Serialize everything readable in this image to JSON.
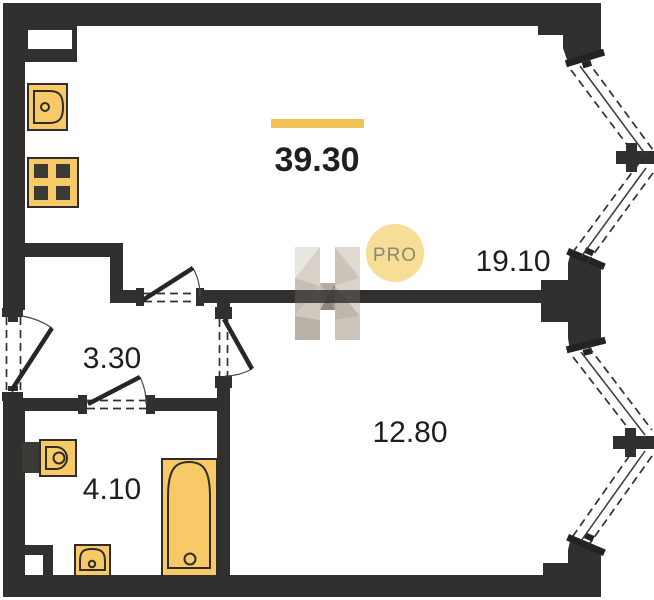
{
  "floor_plan": {
    "total_area": {
      "value": "39.30"
    },
    "rooms": [
      {
        "id": "living-kitchen",
        "area": "19.10"
      },
      {
        "id": "hallway",
        "area": "3.30"
      },
      {
        "id": "bedroom",
        "area": "12.80"
      },
      {
        "id": "bathroom",
        "area": "4.10"
      }
    ],
    "watermark": {
      "badge": "PRO"
    }
  },
  "colors": {
    "wall": "#32302E",
    "fixture_fill": "#F8C967",
    "fixture_stroke": "#2E2D2B",
    "accent": "#EFC255",
    "badge_fill": "#F6DE96",
    "badge_text": "#8D8677",
    "label_text": "#1F1F1F"
  }
}
